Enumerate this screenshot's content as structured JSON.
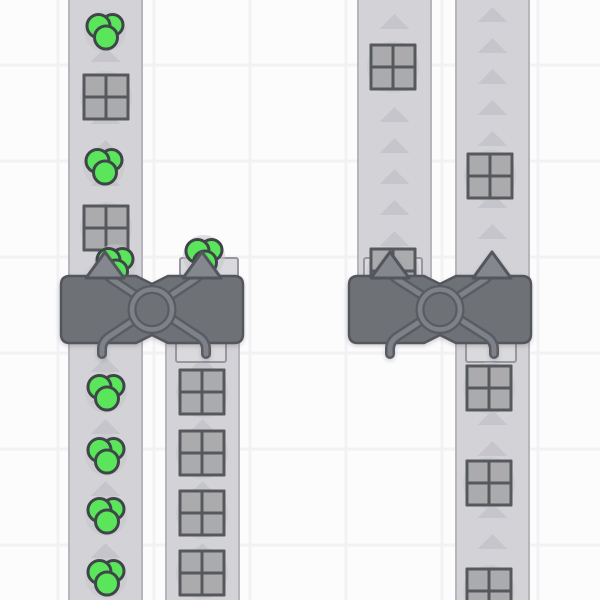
{
  "app": {
    "title": "Factory game viewport with conveyor belts, shape items and balancer buildings"
  },
  "colors": {
    "background": "#fcfcfd",
    "grid_line": "#f2f2f4",
    "belt": "#d3d3d7",
    "belt_edge": "#b5b5bb",
    "belt_arrow": "#c5c5cb",
    "item_shadow": "#c4c4ca",
    "square_fill": "#ababad",
    "square_border": "#55585c",
    "circle_fill": "#5ae55b",
    "circle_border": "#3f4649",
    "building_body": "#6e7176",
    "building_border": "#53565c",
    "pipe_dark": "#595c62",
    "pipe_light": "#7e8187",
    "arrow_fill": "#84878d",
    "pad_fill": "#dadadd",
    "pad_border": "#97979d"
  },
  "scene": {
    "viewport": {
      "width": 600,
      "height": 600
    },
    "grid": {
      "vertical_lines": [
        58,
        154,
        250,
        346,
        442,
        538
      ],
      "horizontal_lines": [
        65,
        161,
        257,
        353,
        449,
        545
      ],
      "line_width": 3
    },
    "arrow_spacing": 31,
    "belts": [
      {
        "id": "belt-left-1",
        "x": 68,
        "y": 0,
        "width": 75,
        "height": 600,
        "arrow_phase": 16
      },
      {
        "id": "belt-left-2",
        "x": 165,
        "y": 340,
        "width": 75,
        "height": 260,
        "arrow_phase": 16
      },
      {
        "id": "belt-right-1",
        "x": 357,
        "y": 0,
        "width": 75,
        "height": 278,
        "arrow_phase": 14
      },
      {
        "id": "belt-right-2",
        "x": 455,
        "y": 0,
        "width": 75,
        "height": 600,
        "arrow_phase": 7
      }
    ],
    "items": [
      {
        "type": "circles",
        "x": 105,
        "y": 31
      },
      {
        "type": "square",
        "x": 106,
        "y": 97
      },
      {
        "type": "circles",
        "x": 104,
        "y": 166
      },
      {
        "type": "square",
        "x": 106,
        "y": 228
      },
      {
        "type": "circles",
        "x": 115,
        "y": 265
      },
      {
        "type": "circles",
        "x": 204,
        "y": 256
      },
      {
        "type": "circles",
        "x": 106,
        "y": 392
      },
      {
        "type": "circles",
        "x": 106,
        "y": 455
      },
      {
        "type": "circles",
        "x": 106,
        "y": 515
      },
      {
        "type": "circles",
        "x": 106,
        "y": 577
      },
      {
        "type": "square",
        "x": 202,
        "y": 392
      },
      {
        "type": "square",
        "x": 202,
        "y": 453
      },
      {
        "type": "square",
        "x": 202,
        "y": 513
      },
      {
        "type": "square",
        "x": 202,
        "y": 573
      },
      {
        "type": "square",
        "x": 393,
        "y": 67
      },
      {
        "type": "square",
        "x": 393,
        "y": 271
      },
      {
        "type": "square",
        "x": 490,
        "y": 176
      },
      {
        "type": "square",
        "x": 489,
        "y": 388
      },
      {
        "type": "square",
        "x": 489,
        "y": 483
      },
      {
        "type": "square",
        "x": 489,
        "y": 591
      }
    ],
    "balancers": [
      {
        "id": "balancer-left",
        "body_x": 61,
        "body_y": 276,
        "body_w": 182,
        "body_h": 67,
        "top_ports": [
          105,
          202
        ],
        "bottom_ports": [
          102,
          206
        ],
        "pads": [
          {
            "x": 180,
            "y": 258,
            "w": 58,
            "h": 19
          },
          {
            "x": 176,
            "y": 342,
            "w": 50,
            "h": 20
          }
        ]
      },
      {
        "id": "balancer-right",
        "body_x": 349,
        "body_y": 276,
        "body_w": 182,
        "body_h": 67,
        "top_ports": [
          390,
          492
        ],
        "bottom_ports": [
          390,
          494
        ],
        "pads": [
          {
            "x": 364,
            "y": 258,
            "w": 58,
            "h": 19
          },
          {
            "x": 466,
            "y": 342,
            "w": 50,
            "h": 20
          }
        ]
      }
    ]
  }
}
